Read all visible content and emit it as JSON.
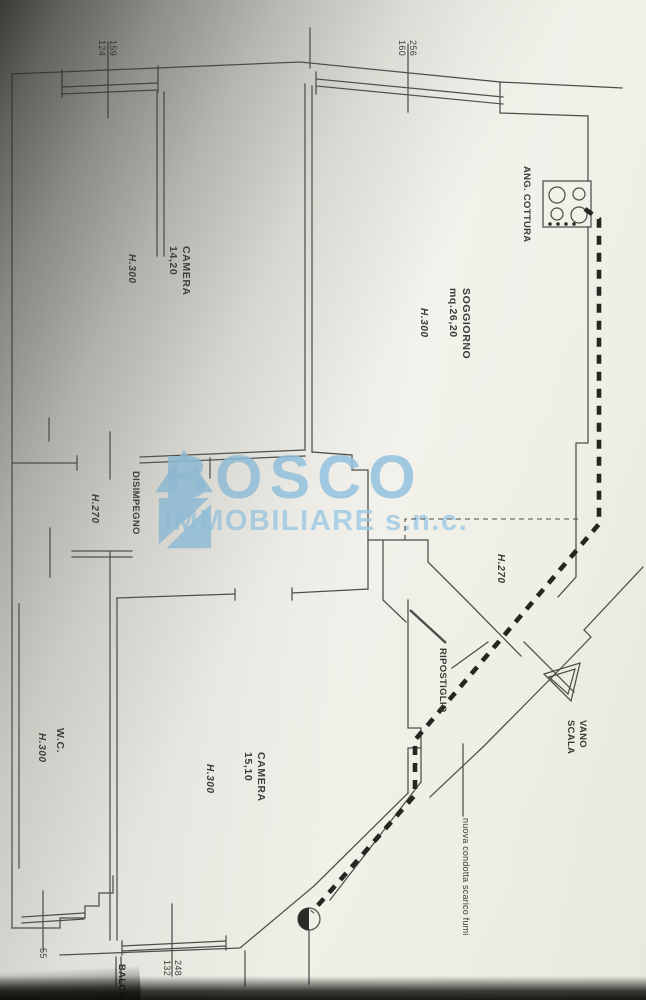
{
  "watermark": {
    "brand": "BOSCO",
    "subtitle": "IMMOBILIARE s.n.c.",
    "color": "#92c2df"
  },
  "rooms": {
    "camera1": {
      "name": "CAMERA",
      "area": "14,20",
      "height": "H.300"
    },
    "soggiorno": {
      "name": "SOGGIORNO",
      "area": "mq.26,20",
      "height": "H.300"
    },
    "angolo_cottura": {
      "name": "ANG. COTTURA"
    },
    "disimpegno": {
      "name": "DISIMPEGNO",
      "height": "H.270"
    },
    "wc": {
      "name": "W.C.",
      "height": "H.300"
    },
    "camera2": {
      "name": "CAMERA",
      "area": "15,10",
      "height": "H.300"
    },
    "ripostiglio": {
      "name": "RIPOSTIGLIO",
      "height": "H.270"
    },
    "vano_scala": {
      "line1": "VANO",
      "line2": "SCALA"
    },
    "balcone": {
      "name": "BALCONE"
    }
  },
  "dimensions": {
    "top_left": {
      "a": "159",
      "b": "124"
    },
    "top_middle": {
      "a": "256",
      "b": "160"
    },
    "bottom": {
      "a": "248",
      "b": "132"
    },
    "bottom_left": {
      "a": "55"
    }
  },
  "annotations": {
    "flue_note": "nuova condotta scarico fumi"
  },
  "symbols": {
    "cooktop": "cooktop-4-burners",
    "flue_outlet": "flue-outlet-circle",
    "stair_arrow": "stair-direction-triangle",
    "house_logo": "house-logo"
  }
}
